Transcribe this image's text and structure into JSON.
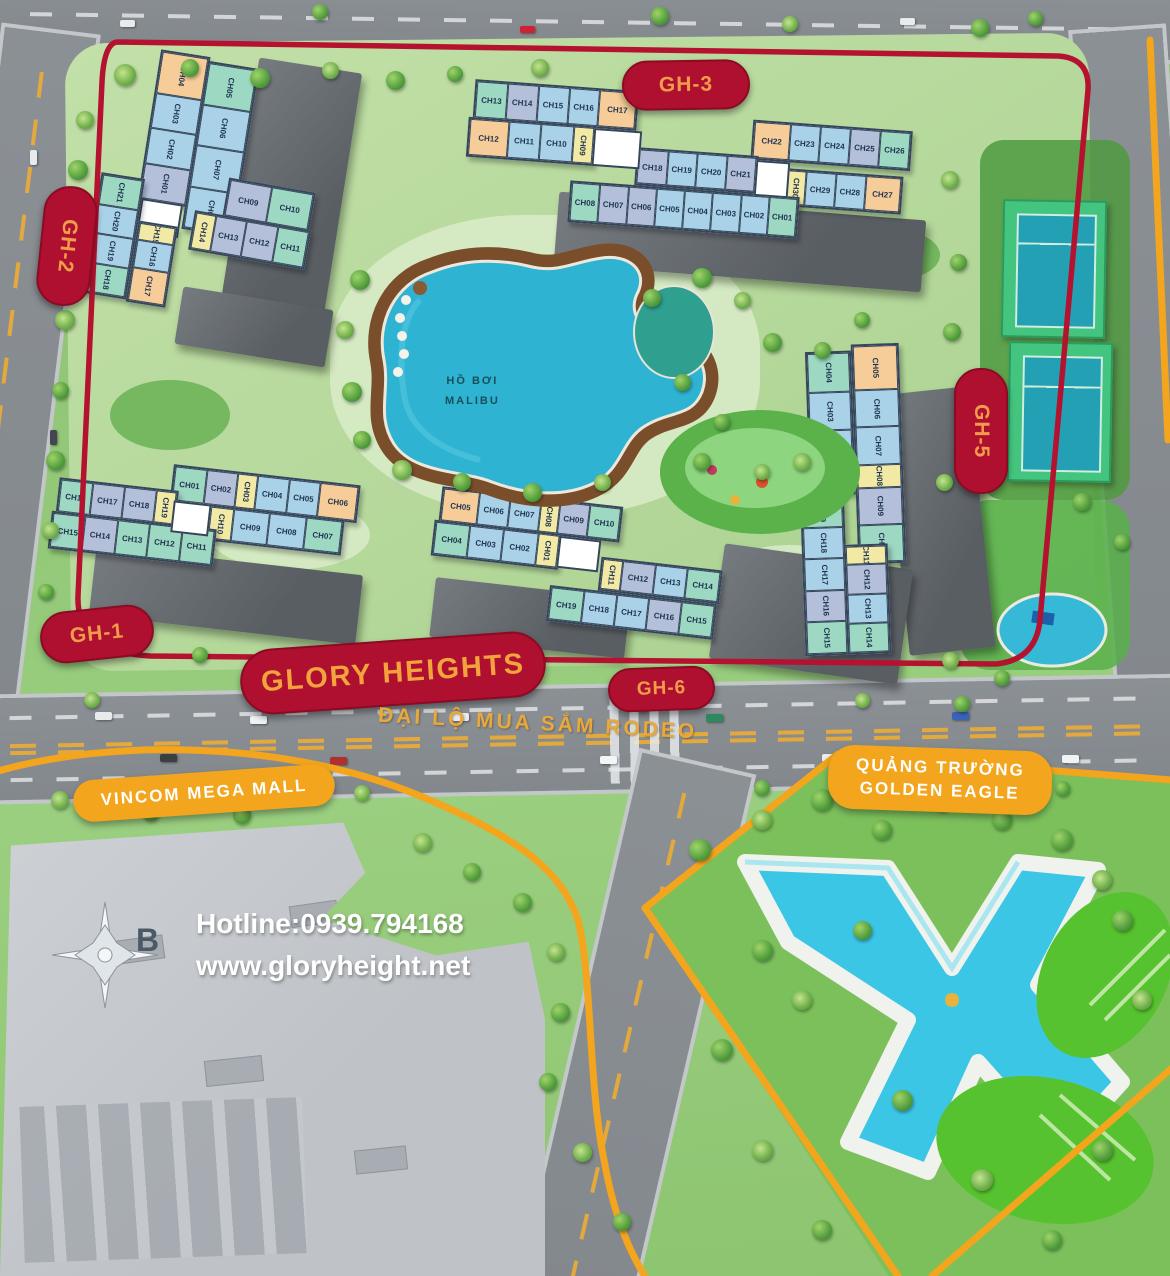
{
  "labels": {
    "glory_heights": "GLORY HEIGHTS",
    "rodeo_boulevard": "ĐẠI LỘ MUA SẮM RODEO",
    "vincom_mall": "VINCOM MEGA MALL",
    "golden_eagle_line1": "QUẢNG TRƯỜNG",
    "golden_eagle_line2": "GOLDEN EAGLE",
    "malibu_pool_line1": "HỒ BƠI",
    "malibu_pool_line2": "MALIBU",
    "hotline": "Hotline:0939.794168",
    "website": "www.gloryheight.net",
    "compass_north": "B"
  },
  "zones": {
    "gh1": {
      "label": "GH-1"
    },
    "gh2": {
      "label": "GH-2"
    },
    "gh3": {
      "label": "GH-3"
    },
    "gh5": {
      "label": "GH-5"
    },
    "gh6": {
      "label": "GH-6"
    }
  },
  "unit_colors": {
    "teal": "#9dd8c2",
    "blue": "#a9d2e8",
    "lavender": "#b4c0da",
    "orange": "#f6cd98",
    "yellow": "#f1e9a4"
  },
  "accents": {
    "zone_badge_red": "#b01030",
    "badge_text_gold": "#f09c4a",
    "landmark_yellow": "#f2a51d",
    "boundary_red": "#b5122f",
    "pool_cyan": "#3cc6e6"
  },
  "buildings": {
    "gh2": {
      "strip_col1": [
        {
          "l": "CH04",
          "c": "orange"
        },
        {
          "l": "CH03",
          "c": "blue"
        },
        {
          "l": "CH02",
          "c": "blue"
        },
        {
          "l": "CH01",
          "c": "lavender"
        }
      ],
      "strip_col2": [
        {
          "l": "CH05",
          "c": "teal"
        },
        {
          "l": "CH06",
          "c": "blue"
        },
        {
          "l": "CH07",
          "c": "blue"
        },
        {
          "l": "CH08",
          "c": "blue"
        }
      ],
      "left_col1": [
        {
          "l": "CH21",
          "c": "teal"
        },
        {
          "l": "CH20",
          "c": "blue"
        },
        {
          "l": "CH19",
          "c": "blue"
        },
        {
          "l": "CH18",
          "c": "teal"
        }
      ],
      "left_col2": [
        {
          "l": "CH15",
          "c": "yellow"
        },
        {
          "l": "CH16",
          "c": "blue"
        },
        {
          "l": "CH17",
          "c": "orange"
        }
      ],
      "right_row1": [
        {
          "l": "CH09",
          "c": "lavender"
        },
        {
          "l": "CH10",
          "c": "teal"
        }
      ],
      "right_row2": [
        {
          "l": "CH14",
          "c": "yellow"
        },
        {
          "l": "CH13",
          "c": "lavender"
        },
        {
          "l": "CH12",
          "c": "lavender"
        },
        {
          "l": "CH11",
          "c": "teal"
        }
      ]
    },
    "gh3": {
      "row1_left": [
        {
          "l": "CH13",
          "c": "teal"
        },
        {
          "l": "CH14",
          "c": "lavender"
        },
        {
          "l": "CH15",
          "c": "blue"
        },
        {
          "l": "CH16",
          "c": "blue"
        },
        {
          "l": "CH17",
          "c": "orange"
        }
      ],
      "row1_right": [
        {
          "l": "CH22",
          "c": "orange"
        },
        {
          "l": "CH23",
          "c": "blue"
        },
        {
          "l": "CH24",
          "c": "blue"
        },
        {
          "l": "CH25",
          "c": "lavender"
        },
        {
          "l": "CH26",
          "c": "teal"
        }
      ],
      "row2_left": [
        {
          "l": "CH12",
          "c": "orange"
        },
        {
          "l": "CH11",
          "c": "blue"
        },
        {
          "l": "CH10",
          "c": "blue"
        },
        {
          "l": "CH09",
          "c": "yellow"
        }
      ],
      "row2_mid": [
        {
          "l": "CH18",
          "c": "lavender"
        },
        {
          "l": "CH19",
          "c": "blue"
        },
        {
          "l": "CH20",
          "c": "blue"
        },
        {
          "l": "CH21",
          "c": "lavender"
        }
      ],
      "row2_right": [
        {
          "l": "CH30",
          "c": "yellow"
        },
        {
          "l": "CH29",
          "c": "blue"
        },
        {
          "l": "CH28",
          "c": "blue"
        },
        {
          "l": "CH27",
          "c": "orange"
        }
      ],
      "row3": [
        {
          "l": "CH08",
          "c": "teal"
        },
        {
          "l": "CH07",
          "c": "lavender"
        },
        {
          "l": "CH06",
          "c": "lavender"
        },
        {
          "l": "CH05",
          "c": "blue"
        },
        {
          "l": "CH04",
          "c": "blue"
        },
        {
          "l": "CH03",
          "c": "blue"
        },
        {
          "l": "CH02",
          "c": "blue"
        },
        {
          "l": "CH01",
          "c": "teal"
        }
      ]
    },
    "gh5": {
      "top_col1": [
        {
          "l": "CH04",
          "c": "teal"
        },
        {
          "l": "CH03",
          "c": "blue"
        },
        {
          "l": "CH02",
          "c": "blue"
        },
        {
          "l": "CH01",
          "c": "yellow"
        }
      ],
      "top_col2": [
        {
          "l": "CH05",
          "c": "orange"
        },
        {
          "l": "CH06",
          "c": "blue"
        },
        {
          "l": "CH07",
          "c": "blue"
        },
        {
          "l": "CH08",
          "c": "yellow"
        },
        {
          "l": "CH09",
          "c": "lavender"
        },
        {
          "l": "CH10",
          "c": "teal"
        }
      ],
      "bot_col1": [
        {
          "l": "CH19",
          "c": "teal"
        },
        {
          "l": "CH18",
          "c": "blue"
        },
        {
          "l": "CH17",
          "c": "blue"
        },
        {
          "l": "CH16",
          "c": "lavender"
        },
        {
          "l": "CH15",
          "c": "teal"
        }
      ],
      "bot_col2": [
        {
          "l": "CH11",
          "c": "yellow"
        },
        {
          "l": "CH12",
          "c": "lavender"
        },
        {
          "l": "CH13",
          "c": "blue"
        },
        {
          "l": "CH14",
          "c": "teal"
        }
      ]
    },
    "gh1": {
      "left_row1": [
        {
          "l": "CH16",
          "c": "teal"
        },
        {
          "l": "CH17",
          "c": "lavender"
        },
        {
          "l": "CH18",
          "c": "lavender"
        },
        {
          "l": "CH19",
          "c": "yellow"
        }
      ],
      "left_row2": [
        {
          "l": "CH15",
          "c": "teal"
        },
        {
          "l": "CH14",
          "c": "lavender"
        },
        {
          "l": "CH13",
          "c": "teal"
        },
        {
          "l": "CH12",
          "c": "teal"
        },
        {
          "l": "CH11",
          "c": "teal"
        }
      ],
      "right_row1": [
        {
          "l": "CH01",
          "c": "teal"
        },
        {
          "l": "CH02",
          "c": "lavender"
        },
        {
          "l": "CH03",
          "c": "yellow"
        },
        {
          "l": "CH04",
          "c": "blue"
        },
        {
          "l": "CH05",
          "c": "blue"
        },
        {
          "l": "CH06",
          "c": "orange"
        }
      ],
      "right_row2": [
        {
          "l": "CH10",
          "c": "yellow"
        },
        {
          "l": "CH09",
          "c": "blue"
        },
        {
          "l": "CH08",
          "c": "blue"
        },
        {
          "l": "CH07",
          "c": "teal"
        }
      ]
    },
    "gh6": {
      "top_row1": [
        {
          "l": "CH05",
          "c": "orange"
        },
        {
          "l": "CH06",
          "c": "blue"
        },
        {
          "l": "CH07",
          "c": "blue"
        },
        {
          "l": "CH08",
          "c": "yellow"
        },
        {
          "l": "CH09",
          "c": "lavender"
        },
        {
          "l": "CH10",
          "c": "teal"
        }
      ],
      "top_row2": [
        {
          "l": "CH04",
          "c": "teal"
        },
        {
          "l": "CH03",
          "c": "blue"
        },
        {
          "l": "CH02",
          "c": "blue"
        },
        {
          "l": "CH01",
          "c": "yellow"
        }
      ],
      "bot_row1": [
        {
          "l": "CH11",
          "c": "yellow"
        },
        {
          "l": "CH12",
          "c": "lavender"
        },
        {
          "l": "CH13",
          "c": "blue"
        },
        {
          "l": "CH14",
          "c": "teal"
        }
      ],
      "bot_row2": [
        {
          "l": "CH19",
          "c": "teal"
        },
        {
          "l": "CH18",
          "c": "blue"
        },
        {
          "l": "CH17",
          "c": "blue"
        },
        {
          "l": "CH16",
          "c": "lavender"
        },
        {
          "l": "CH15",
          "c": "teal"
        }
      ]
    }
  }
}
